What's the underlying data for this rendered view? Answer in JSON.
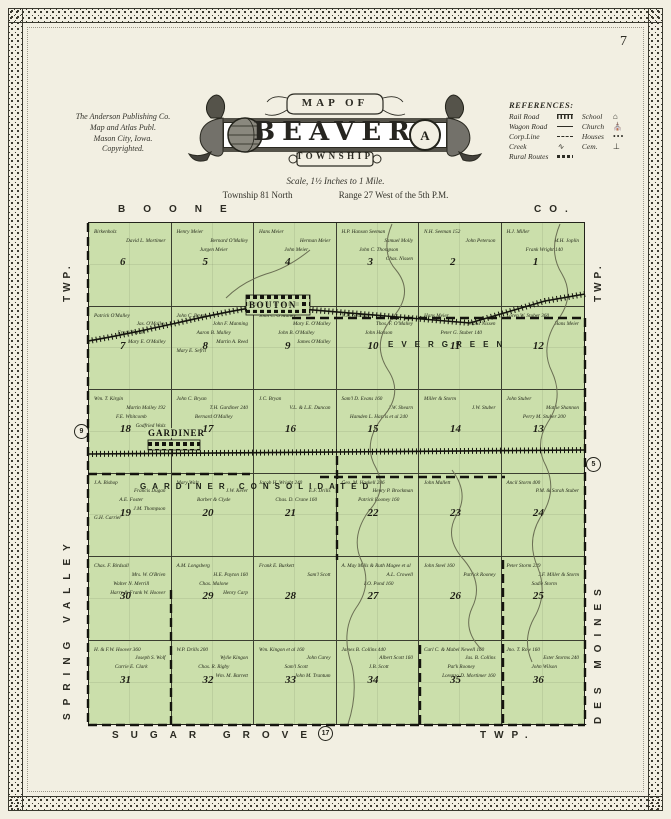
{
  "page": {
    "number": "7"
  },
  "publisher": {
    "line1": "The Anderson Publishing Co.",
    "line2": "Map and Atlas Publ.",
    "line3": "Mason City, Iowa.",
    "line4": "Copyrighted."
  },
  "title": {
    "map_of": "MAP OF",
    "name": "BEAVER",
    "township_word": "TOWNSHIP",
    "scale": "Scale, 1½ Inches to 1 Mile.",
    "township_line": "Township 81 North",
    "range_line": "Range 27 West of the 5th P.M."
  },
  "references": {
    "heading": "REFERENCES:",
    "items": [
      {
        "label": "Rail Road",
        "icon": "railroad-symbol"
      },
      {
        "label": "School",
        "icon": "school-icon",
        "glyph": "⌂"
      },
      {
        "label": "Wagon Road",
        "icon": "road-symbol"
      },
      {
        "label": "Church",
        "icon": "church-icon",
        "glyph": "⛪"
      },
      {
        "label": "Corp.Line",
        "icon": "corpline-symbol"
      },
      {
        "label": "Houses",
        "icon": "houses-symbol",
        "glyph": "•••"
      },
      {
        "label": "Creek",
        "icon": "creek-symbol",
        "glyph": "∿"
      },
      {
        "label": "Cem.",
        "icon": "cemetery-symbol",
        "glyph": "⊥"
      },
      {
        "label": "Rural Routes",
        "icon": "ruralroute-symbol"
      }
    ]
  },
  "map": {
    "border_labels": {
      "top_left": "BOONE",
      "top_right": "CO.",
      "left_top": "TWP.",
      "left_side": "SPRING VALLEY",
      "right_top": "TWP.",
      "right_side": "DES MOINES",
      "bottom_left": "SUGAR GROVE",
      "bottom_right": "TWP."
    },
    "route_markers": {
      "left": "9",
      "right": "5",
      "bottom": "17"
    },
    "towns": [
      {
        "name": "BOUTON"
      },
      {
        "name": "GARDINER"
      }
    ],
    "districts": [
      {
        "label": "EVERGREEN"
      },
      {
        "label": "GARDINER CONSOLIDATED"
      }
    ],
    "sections": [
      {
        "num": "6",
        "owners": [
          "Birkenholz",
          "David L. Mortimer"
        ]
      },
      {
        "num": "5",
        "owners": [
          "Henry Meier",
          "Bernard O'Malley",
          "Jurgen Meier"
        ]
      },
      {
        "num": "4",
        "owners": [
          "Hans Meier",
          "Herman Meier",
          "John Meier"
        ]
      },
      {
        "num": "3",
        "owners": [
          "H.P. Hanson Seeman",
          "Samuel Molly",
          "John C. Thompson",
          "Chas. Nissen"
        ]
      },
      {
        "num": "2",
        "owners": [
          "N.H. Seeman 152",
          "John Peterson"
        ]
      },
      {
        "num": "1",
        "owners": [
          "H.J. Miller",
          "M.H. Joplin",
          "Frank Wright 140"
        ]
      },
      {
        "num": "7",
        "owners": [
          "Patrick O'Malley",
          "Jas. O'Malley",
          "Frank Parcel",
          "Mary E. O'Malley"
        ]
      },
      {
        "num": "8",
        "owners": [
          "John C. Bryan",
          "John F. Manning",
          "Aaron B. Malley",
          "Martin A. Reed",
          "Mary E. Sefrit"
        ]
      },
      {
        "num": "9",
        "owners": [
          "John C. O'Malley",
          "Mary E. O'Malley",
          "John B. O'Malley",
          "James O'Malley"
        ]
      },
      {
        "num": "10",
        "owners": [
          "N.H. Seaman",
          "Thos. F. O'Malley",
          "John Hanson"
        ]
      },
      {
        "num": "11",
        "owners": [
          "Hans Meier",
          "Claus Nissen",
          "Peter G. Stuber 140"
        ]
      },
      {
        "num": "12",
        "owners": [
          "Loren W. Stuber 360",
          "Hans Meier"
        ]
      },
      {
        "num": "18",
        "owners": [
          "Wm. T. Kirgin",
          "Martin Malley 192",
          "F.E. Whitcomb",
          "Godfried Walz"
        ]
      },
      {
        "num": "17",
        "owners": [
          "John C. Bryan",
          "T.H. Gardiner 240",
          "Bernard O'Malley"
        ]
      },
      {
        "num": "16",
        "owners": [
          "J.C. Bryan",
          "V.L. & L.E. Duncan"
        ]
      },
      {
        "num": "15",
        "owners": [
          "Sam'l D. Evans 160",
          "J.W. Shearn",
          "Hamden L. Harris et al 240"
        ]
      },
      {
        "num": "14",
        "owners": [
          "Miller & Storm",
          "J.W. Stuber"
        ]
      },
      {
        "num": "13",
        "owners": [
          "John Stuber",
          "Mattie Shannon",
          "Perry M. Stuber 200"
        ]
      },
      {
        "num": "19",
        "owners": [
          "J.A. Bishop",
          "Francis Dugan",
          "A.E. Foster",
          "J.M. Thompson",
          "G.H. Carrier"
        ]
      },
      {
        "num": "20",
        "owners": [
          "Mary Walz",
          "J.W. Kerer",
          "Barber & Clyde"
        ]
      },
      {
        "num": "21",
        "owners": [
          "Jacob H. Wright 240",
          "E.F. Drills",
          "Chas. D. Crane 160"
        ]
      },
      {
        "num": "22",
        "owners": [
          "Geo. M. Haskell 286",
          "Henry P. Brockman",
          "Patrick Rooney 160"
        ]
      },
      {
        "num": "23",
        "owners": [
          "John Mallett"
        ]
      },
      {
        "num": "24",
        "owners": [
          "Ancil Storm 400",
          "P.M. & Sarah Stuber"
        ]
      },
      {
        "num": "30",
        "owners": [
          "Chas. F. Birdsall",
          "Mrs. W. O'Brien",
          "Walter N. Merrill",
          "Harry & Frank W. Hoover"
        ]
      },
      {
        "num": "29",
        "owners": [
          "A.M. Longsberg",
          "H.E. Payton 160",
          "Chas. Malone",
          "Henry Carp"
        ]
      },
      {
        "num": "28",
        "owners": [
          "Frank E. Burkett",
          "Sam'l Scott"
        ]
      },
      {
        "num": "27",
        "owners": [
          "A. May Mills & Ruth Magee et al",
          "A.L. Crowell",
          "I.O. Pond 160"
        ]
      },
      {
        "num": "26",
        "owners": [
          "John Steel 160",
          "Patrick Rooney"
        ]
      },
      {
        "num": "25",
        "owners": [
          "Peter Storm 239",
          "J.F. Miller & Storm",
          "Sadie Storm"
        ]
      },
      {
        "num": "31",
        "owners": [
          "H. & F.W. Hoover 360",
          "Joseph S. Wolf",
          "Carrie E. Clark"
        ]
      },
      {
        "num": "32",
        "owners": [
          "W.P. Drills 200",
          "Wylie Kingon",
          "Chas. R. Rigby",
          "Wm. M. Barrett"
        ]
      },
      {
        "num": "33",
        "owners": [
          "Wm. Kingon et al 160",
          "John Carey",
          "Sam'l Scott",
          "John M. Trantum"
        ]
      },
      {
        "num": "34",
        "owners": [
          "James B. Collins 440",
          "Albert Scott 160",
          "J.B. Scott"
        ]
      },
      {
        "num": "35",
        "owners": [
          "Carl C. & Mabel Newell 160",
          "Jas. B. Collins",
          "Pat'k Rooney",
          "Lorenzo D. Mortimer 160"
        ]
      },
      {
        "num": "36",
        "owners": [
          "Jno. T. Row 160",
          "Ester Storms 240",
          "John Wilson"
        ]
      }
    ]
  },
  "colors": {
    "paper": "#f2efe2",
    "section_green": "#cbdfab",
    "ink": "#23231b",
    "creek": "#6b6f54"
  }
}
